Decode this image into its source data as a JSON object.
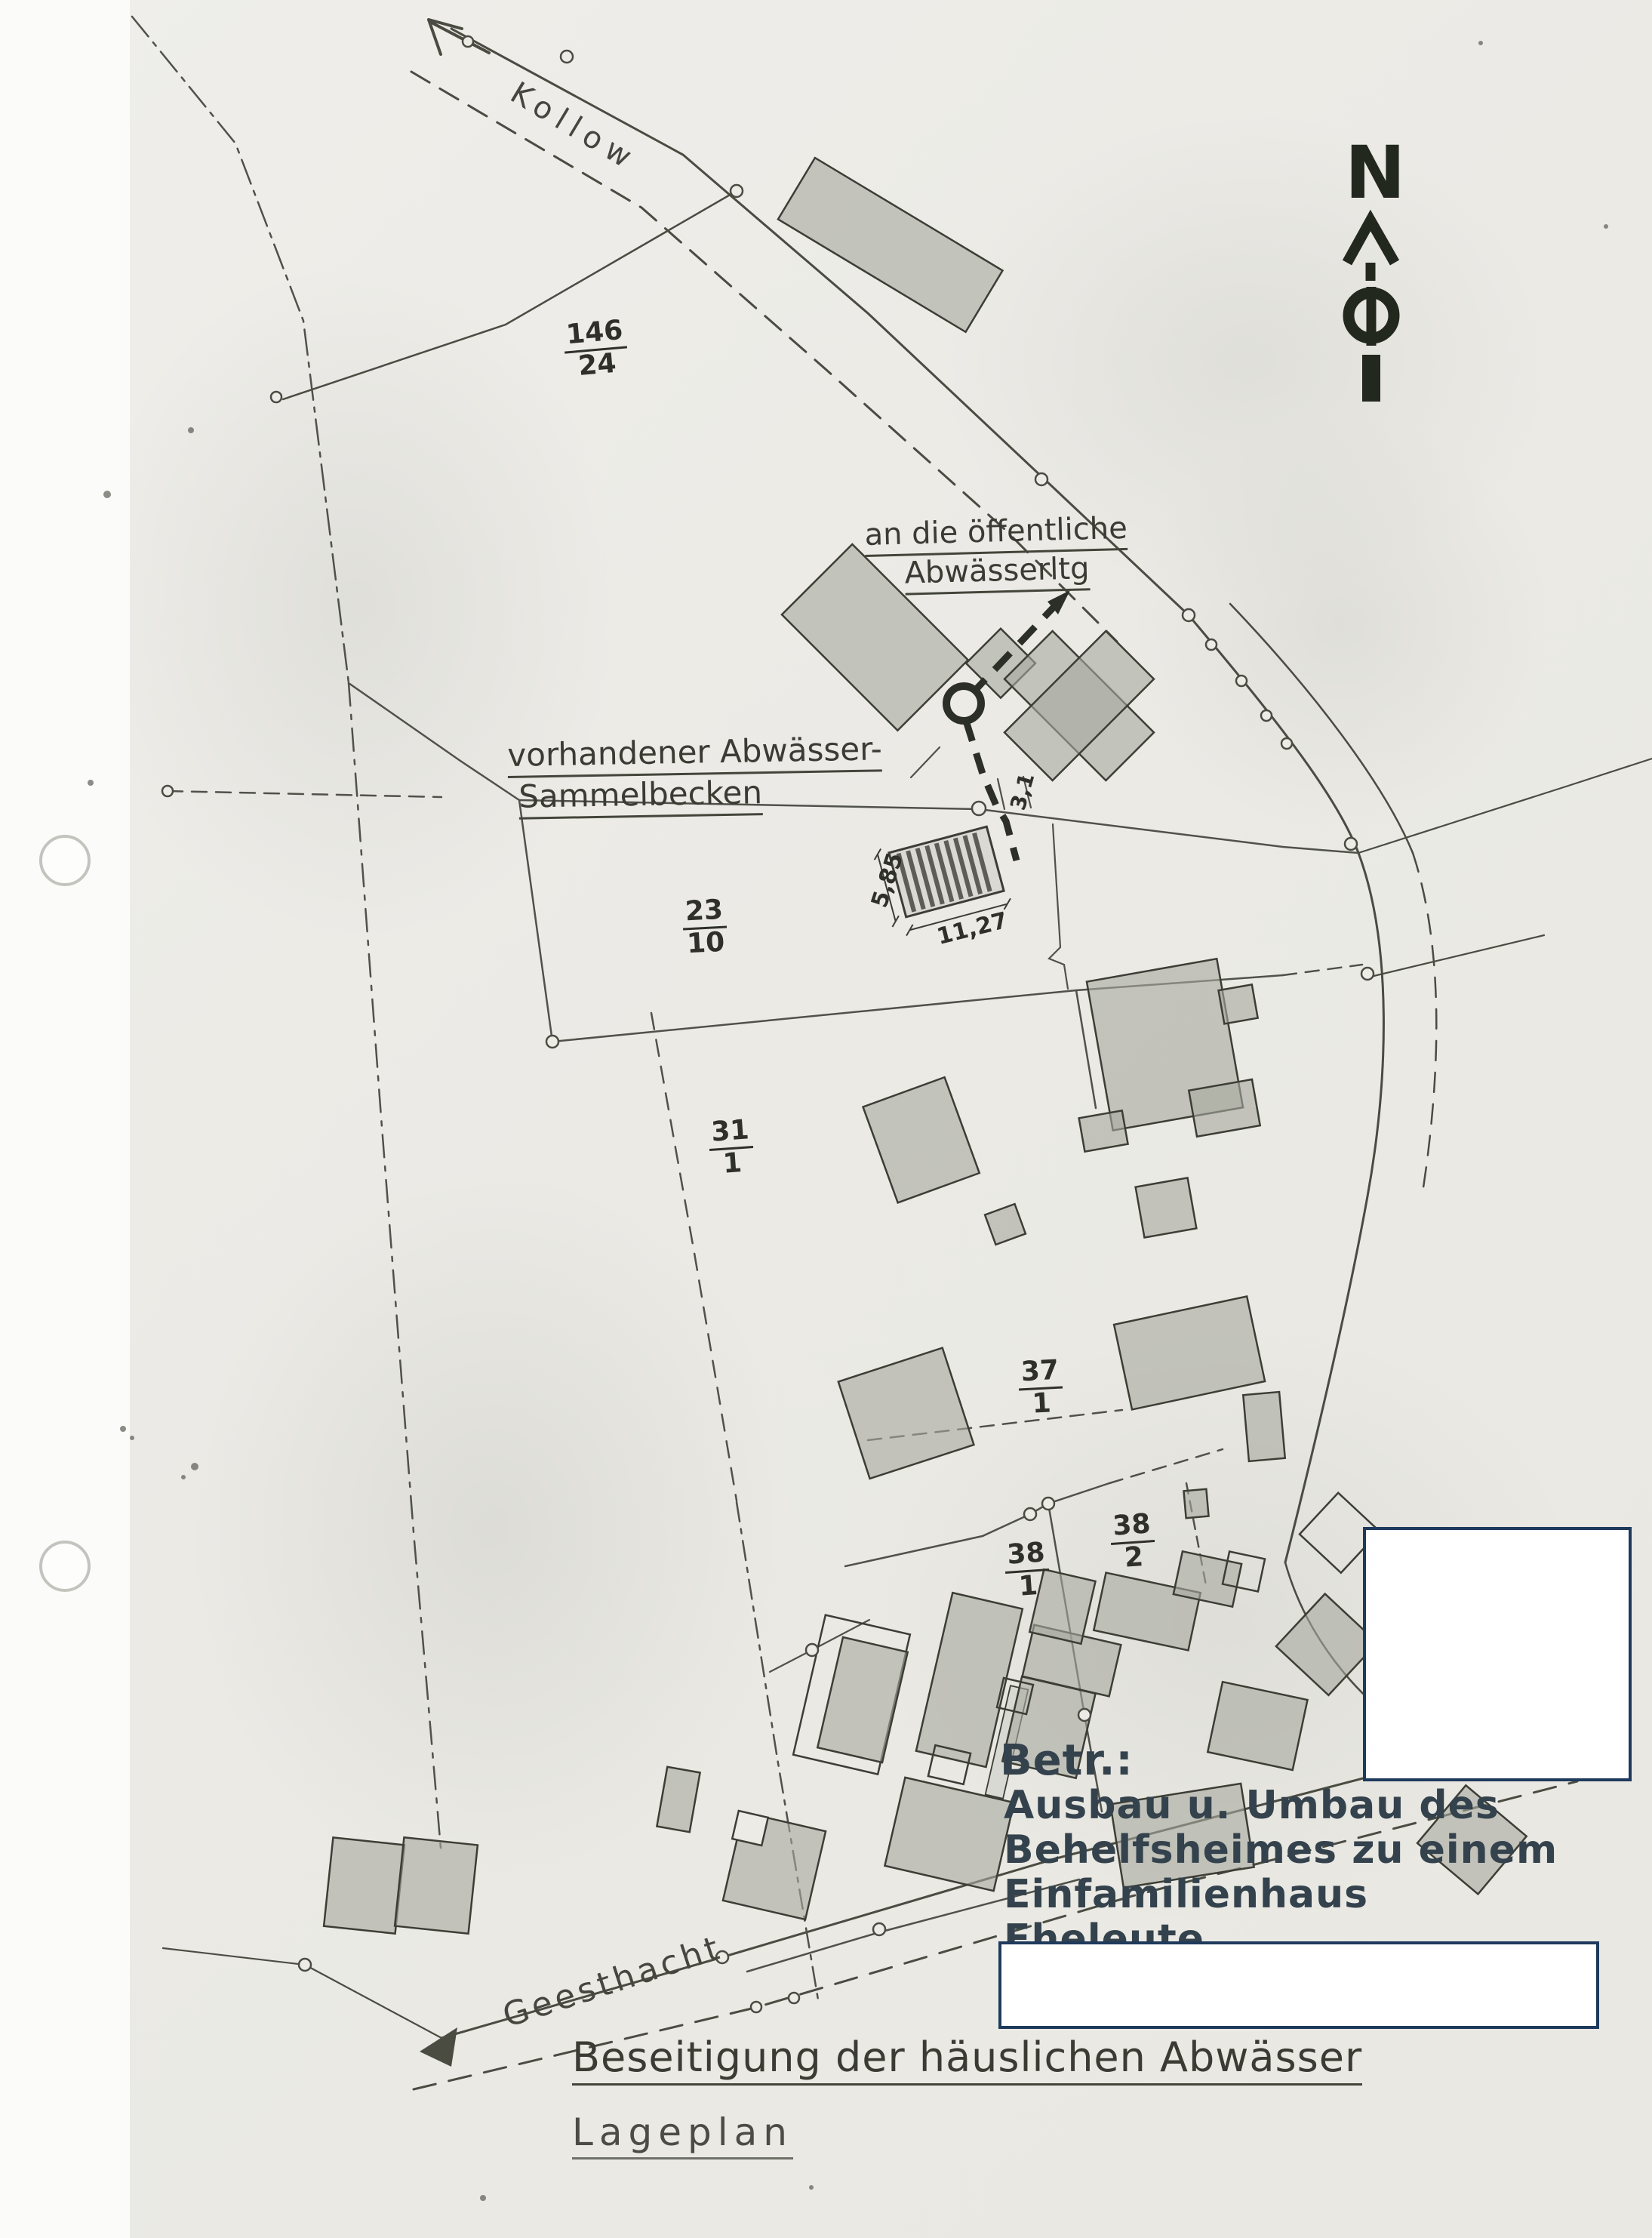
{
  "north": {
    "label": "N"
  },
  "road_labels": {
    "kollow": "Kollow",
    "geesthacht": "Geesthacht"
  },
  "annotations": {
    "public_sewer": {
      "line1": "an die öffentliche",
      "line2": "Abwässerltg"
    },
    "collection_basin": {
      "line1": "vorhandener Abwässer-",
      "line2": "Sammelbecken"
    }
  },
  "parcel_numbers": [
    {
      "id": "146/24",
      "numerator": "146",
      "denominator": "24"
    },
    {
      "id": "23/10",
      "numerator": "23",
      "denominator": "10"
    },
    {
      "id": "31/1",
      "numerator": "31",
      "denominator": "1"
    },
    {
      "id": "37/1",
      "numerator": "37",
      "denominator": "1"
    },
    {
      "id": "38/1",
      "numerator": "38",
      "denominator": "1"
    },
    {
      "id": "38/2",
      "numerator": "38",
      "denominator": "2"
    }
  ],
  "measurements": {
    "basin_width": "5,85",
    "basin_length": "11,27",
    "pipe_offset": "3,1"
  },
  "subject": {
    "label": "Betr.:",
    "lines": [
      "Ausbau u. Umbau des",
      "Behelfsheimes zu einem",
      "Einfamilienhaus",
      "Eheleute"
    ]
  },
  "titles": {
    "main": "Beseitigung der häuslichen Abwässer",
    "subtitle": "Lageplan"
  },
  "colors": {
    "paper": "#edebe6",
    "ink": "#4a4c42",
    "building_fill": "#a7a99f",
    "subject_ink": "#34424d",
    "redaction_border": "#1e3a5c",
    "north_ink": "#23281f"
  }
}
